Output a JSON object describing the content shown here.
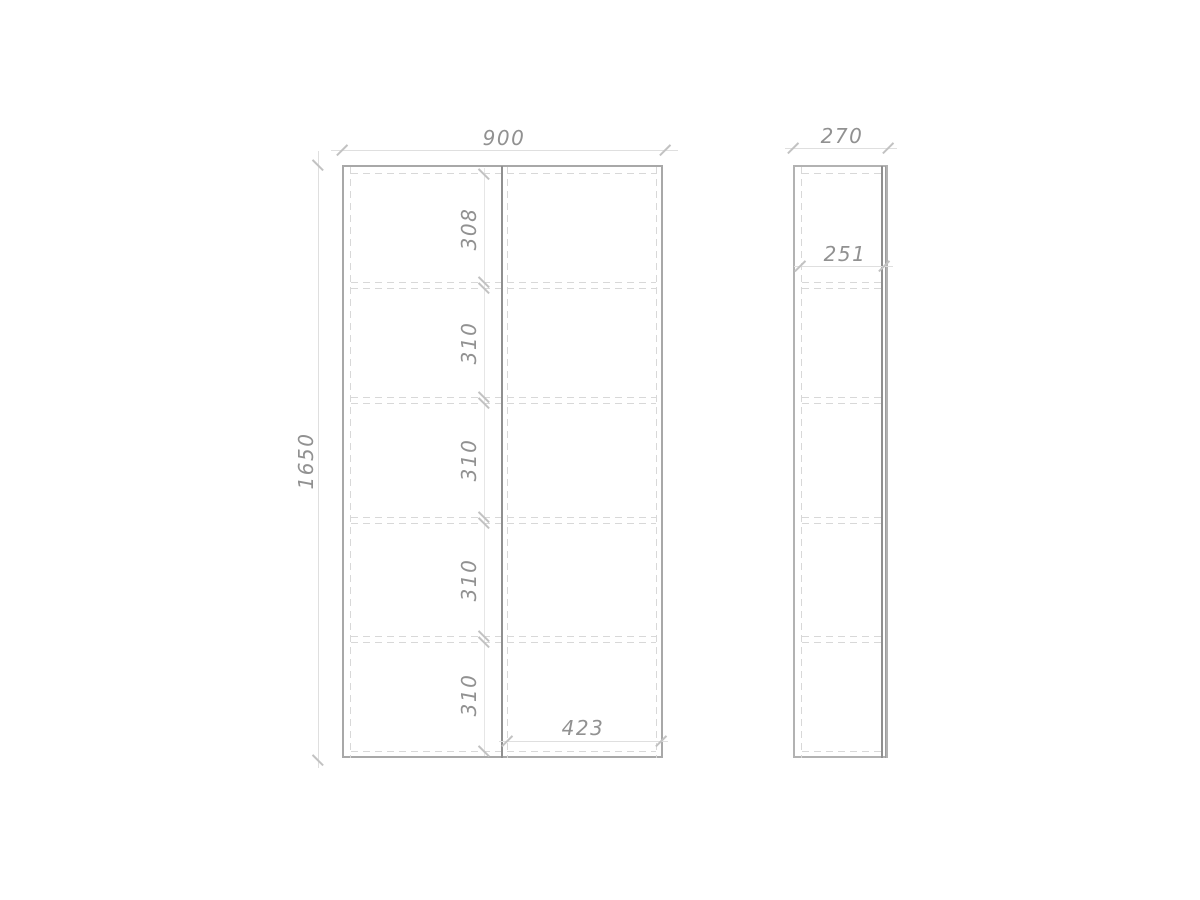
{
  "drawing": {
    "type": "furniture-technical-drawing",
    "front_view": {
      "width": "900",
      "height": "1650",
      "right_door_width": "423",
      "shelf_sections": [
        "308",
        "310",
        "310",
        "310",
        "310"
      ]
    },
    "side_view": {
      "depth": "270",
      "inner_depth": "251"
    },
    "colors": {
      "background": "#ffffff",
      "outline": "#a8a8a8",
      "door_split_line": "#8f8f8f",
      "dashed_line": "#d8d8d8",
      "dimension_line": "#dfdfdf",
      "tick_mark": "#c2c2c2",
      "dimension_text": "#919191"
    }
  }
}
